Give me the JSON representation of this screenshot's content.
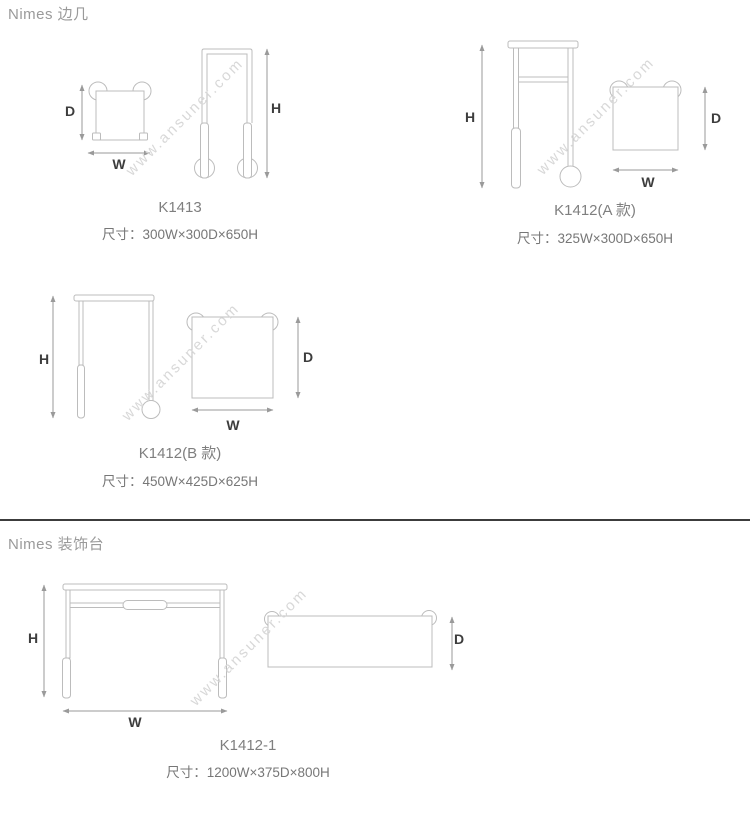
{
  "page": {
    "background": "#ffffff",
    "colors": {
      "furniture_line": "#bcbcbc",
      "dimension_arrow": "#9a9a9a",
      "dimension_letter": "#3d3d3d",
      "section_heading": "#9a9a9a",
      "model_title": "#7f7f7f",
      "size_text": "#777777",
      "watermark": "#d8d8d8",
      "divider": "#3c3c3c"
    }
  },
  "watermark": {
    "text": "www.ansuner.com"
  },
  "dimension_letters": {
    "width": "W",
    "depth": "D",
    "height": "H"
  },
  "sections": [
    {
      "heading": "Nimes 边几",
      "products": [
        {
          "model": "K1413",
          "size_label": "尺寸：300W×300D×650H"
        },
        {
          "model": "K1412(A 款)",
          "size_label": "尺寸：325W×300D×650H"
        },
        {
          "model": "K1412(B 款)",
          "size_label": "尺寸：450W×425D×625H"
        }
      ]
    },
    {
      "heading": "Nimes 装饰台",
      "products": [
        {
          "model": "K1412-1",
          "size_label": "尺寸：1200W×375D×800H"
        }
      ]
    }
  ]
}
